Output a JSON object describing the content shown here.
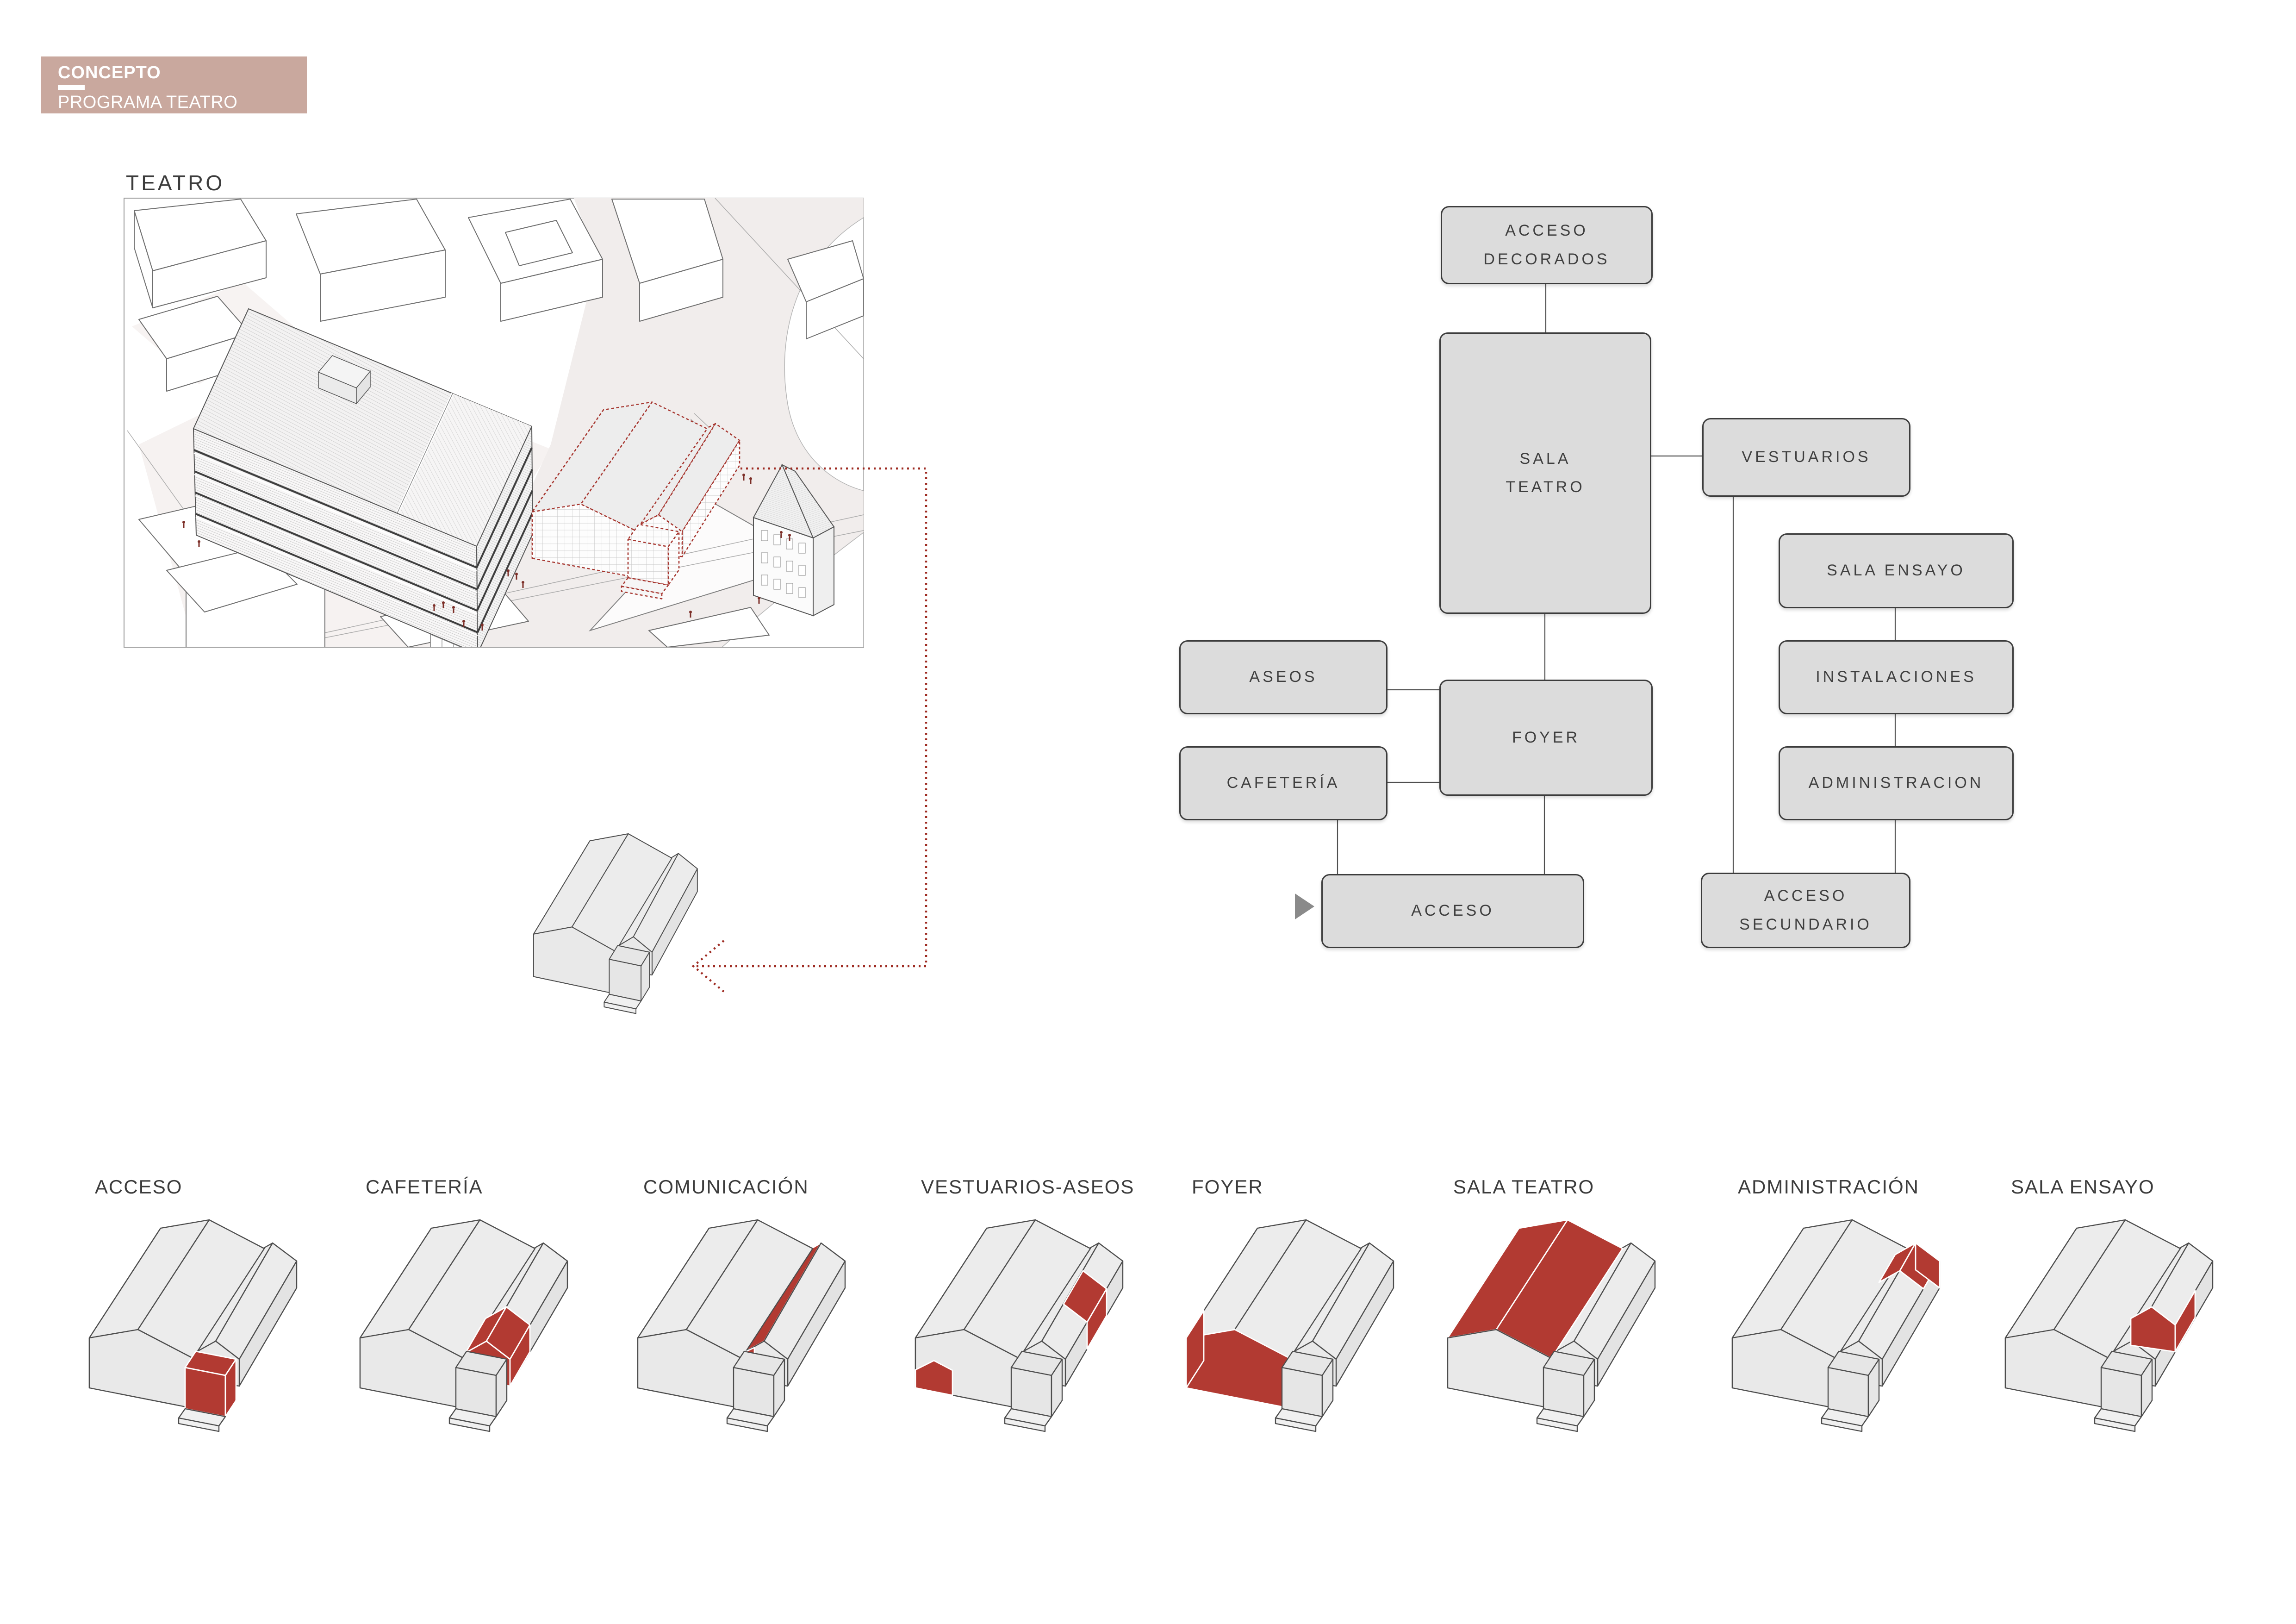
{
  "header": {
    "title": "CONCEPTO",
    "subtitle": "PROGRAMA TEATRO"
  },
  "site_plan": {
    "label": "TEATRO"
  },
  "flow": {
    "boxes": {
      "acceso_decorados": {
        "lines": [
          "ACCESO",
          "DECORADOS"
        ]
      },
      "sala_teatro": {
        "lines": [
          "SALA",
          "TEATRO"
        ]
      },
      "vestuarios": {
        "lines": [
          "VESTUARIOS"
        ]
      },
      "sala_ensayo": {
        "lines": [
          "SALA ENSAYO"
        ]
      },
      "instalaciones": {
        "lines": [
          "INSTALACIONES"
        ]
      },
      "aseos": {
        "lines": [
          "ASEOS"
        ]
      },
      "foyer": {
        "lines": [
          "FOYER"
        ]
      },
      "cafeteria": {
        "lines": [
          "CAFETERÍA"
        ]
      },
      "administracion": {
        "lines": [
          "ADMINISTRACION"
        ]
      },
      "acceso": {
        "lines": [
          "ACCESO"
        ]
      },
      "acceso_secundario": {
        "lines": [
          "ACCESO",
          "SECUNDARIO"
        ]
      }
    }
  },
  "legend": [
    {
      "label": "ACCESO",
      "red_parts": [
        "cube-top",
        "cube-front",
        "cube-side"
      ]
    },
    {
      "label": "CAFETERÍA",
      "red_parts": [
        "annex-front-gable",
        "annex-roof-front-l",
        "annex-roof-front-r",
        "annex-wall-front"
      ]
    },
    {
      "label": "COMUNICACIÓN",
      "red_parts": [
        "annex-left-roof",
        "comm-front-sliver"
      ]
    },
    {
      "label": "VESTUARIOS-ASEOS",
      "red_parts": [
        "vest-front-box",
        "annex-roof-mid",
        "annex-wall-mid"
      ]
    },
    {
      "label": "FOYER",
      "red_parts": [
        "front-gable",
        "left-wall-front"
      ]
    },
    {
      "label": "SALA TEATRO",
      "red_parts": [
        "left-roof",
        "right-roof",
        "right-wall"
      ]
    },
    {
      "label": "ADMINISTRACIÓN",
      "red_parts": [
        "annex-roof-rear-l",
        "annex-roof-rear-r",
        "admin-end-face"
      ]
    },
    {
      "label": "SALA ENSAYO",
      "red_parts": [
        "ensayo-gable",
        "ensayo-wall"
      ]
    }
  ],
  "colors": {
    "badge_bg": "#c9a89e",
    "badge_text": "#ffffff",
    "heading_text": "#3c3c3c",
    "red": "#b23a32",
    "dashed_red": "#a6352e",
    "arrow_red": "#9e2b22",
    "people_red": "#7c2e27",
    "box_fill": "#dcdcdc",
    "box_border": "#3c3c3c",
    "box_text": "#3f3f3f",
    "connector": "#4f4f4f",
    "building_stroke": "#4d4d4d",
    "triangle_gray": "#8a8a8a"
  }
}
